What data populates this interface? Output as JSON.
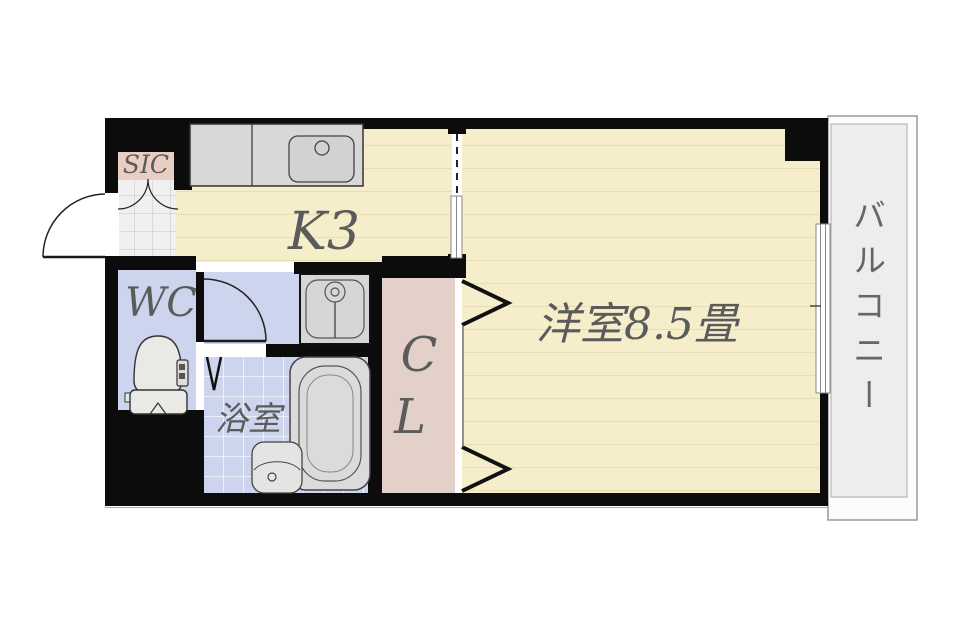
{
  "floorplan": {
    "rooms": {
      "sic": {
        "label": "SIC"
      },
      "kitchen": {
        "label": "K3"
      },
      "wc": {
        "label": "WC"
      },
      "bath": {
        "label": "浴室"
      },
      "closet": {
        "line1": "C",
        "line2": "L"
      },
      "main_room": {
        "label": "洋室8.5畳"
      },
      "balcony": {
        "label": "バルコニー"
      }
    },
    "colors": {
      "wall": "#0c0c0c",
      "wood_floor": "#f6eecb",
      "wood_line": "#e9ddb4",
      "wet_floor": "#cdd4ee",
      "closet_floor": "#e3d0c9",
      "sic_floor": "#e9cfc3",
      "fixture": "#d8d8d8",
      "balcony_floor": "#ededef",
      "genkan_tile": "#f0f0f0",
      "label_text": "#5b5b5b"
    }
  }
}
